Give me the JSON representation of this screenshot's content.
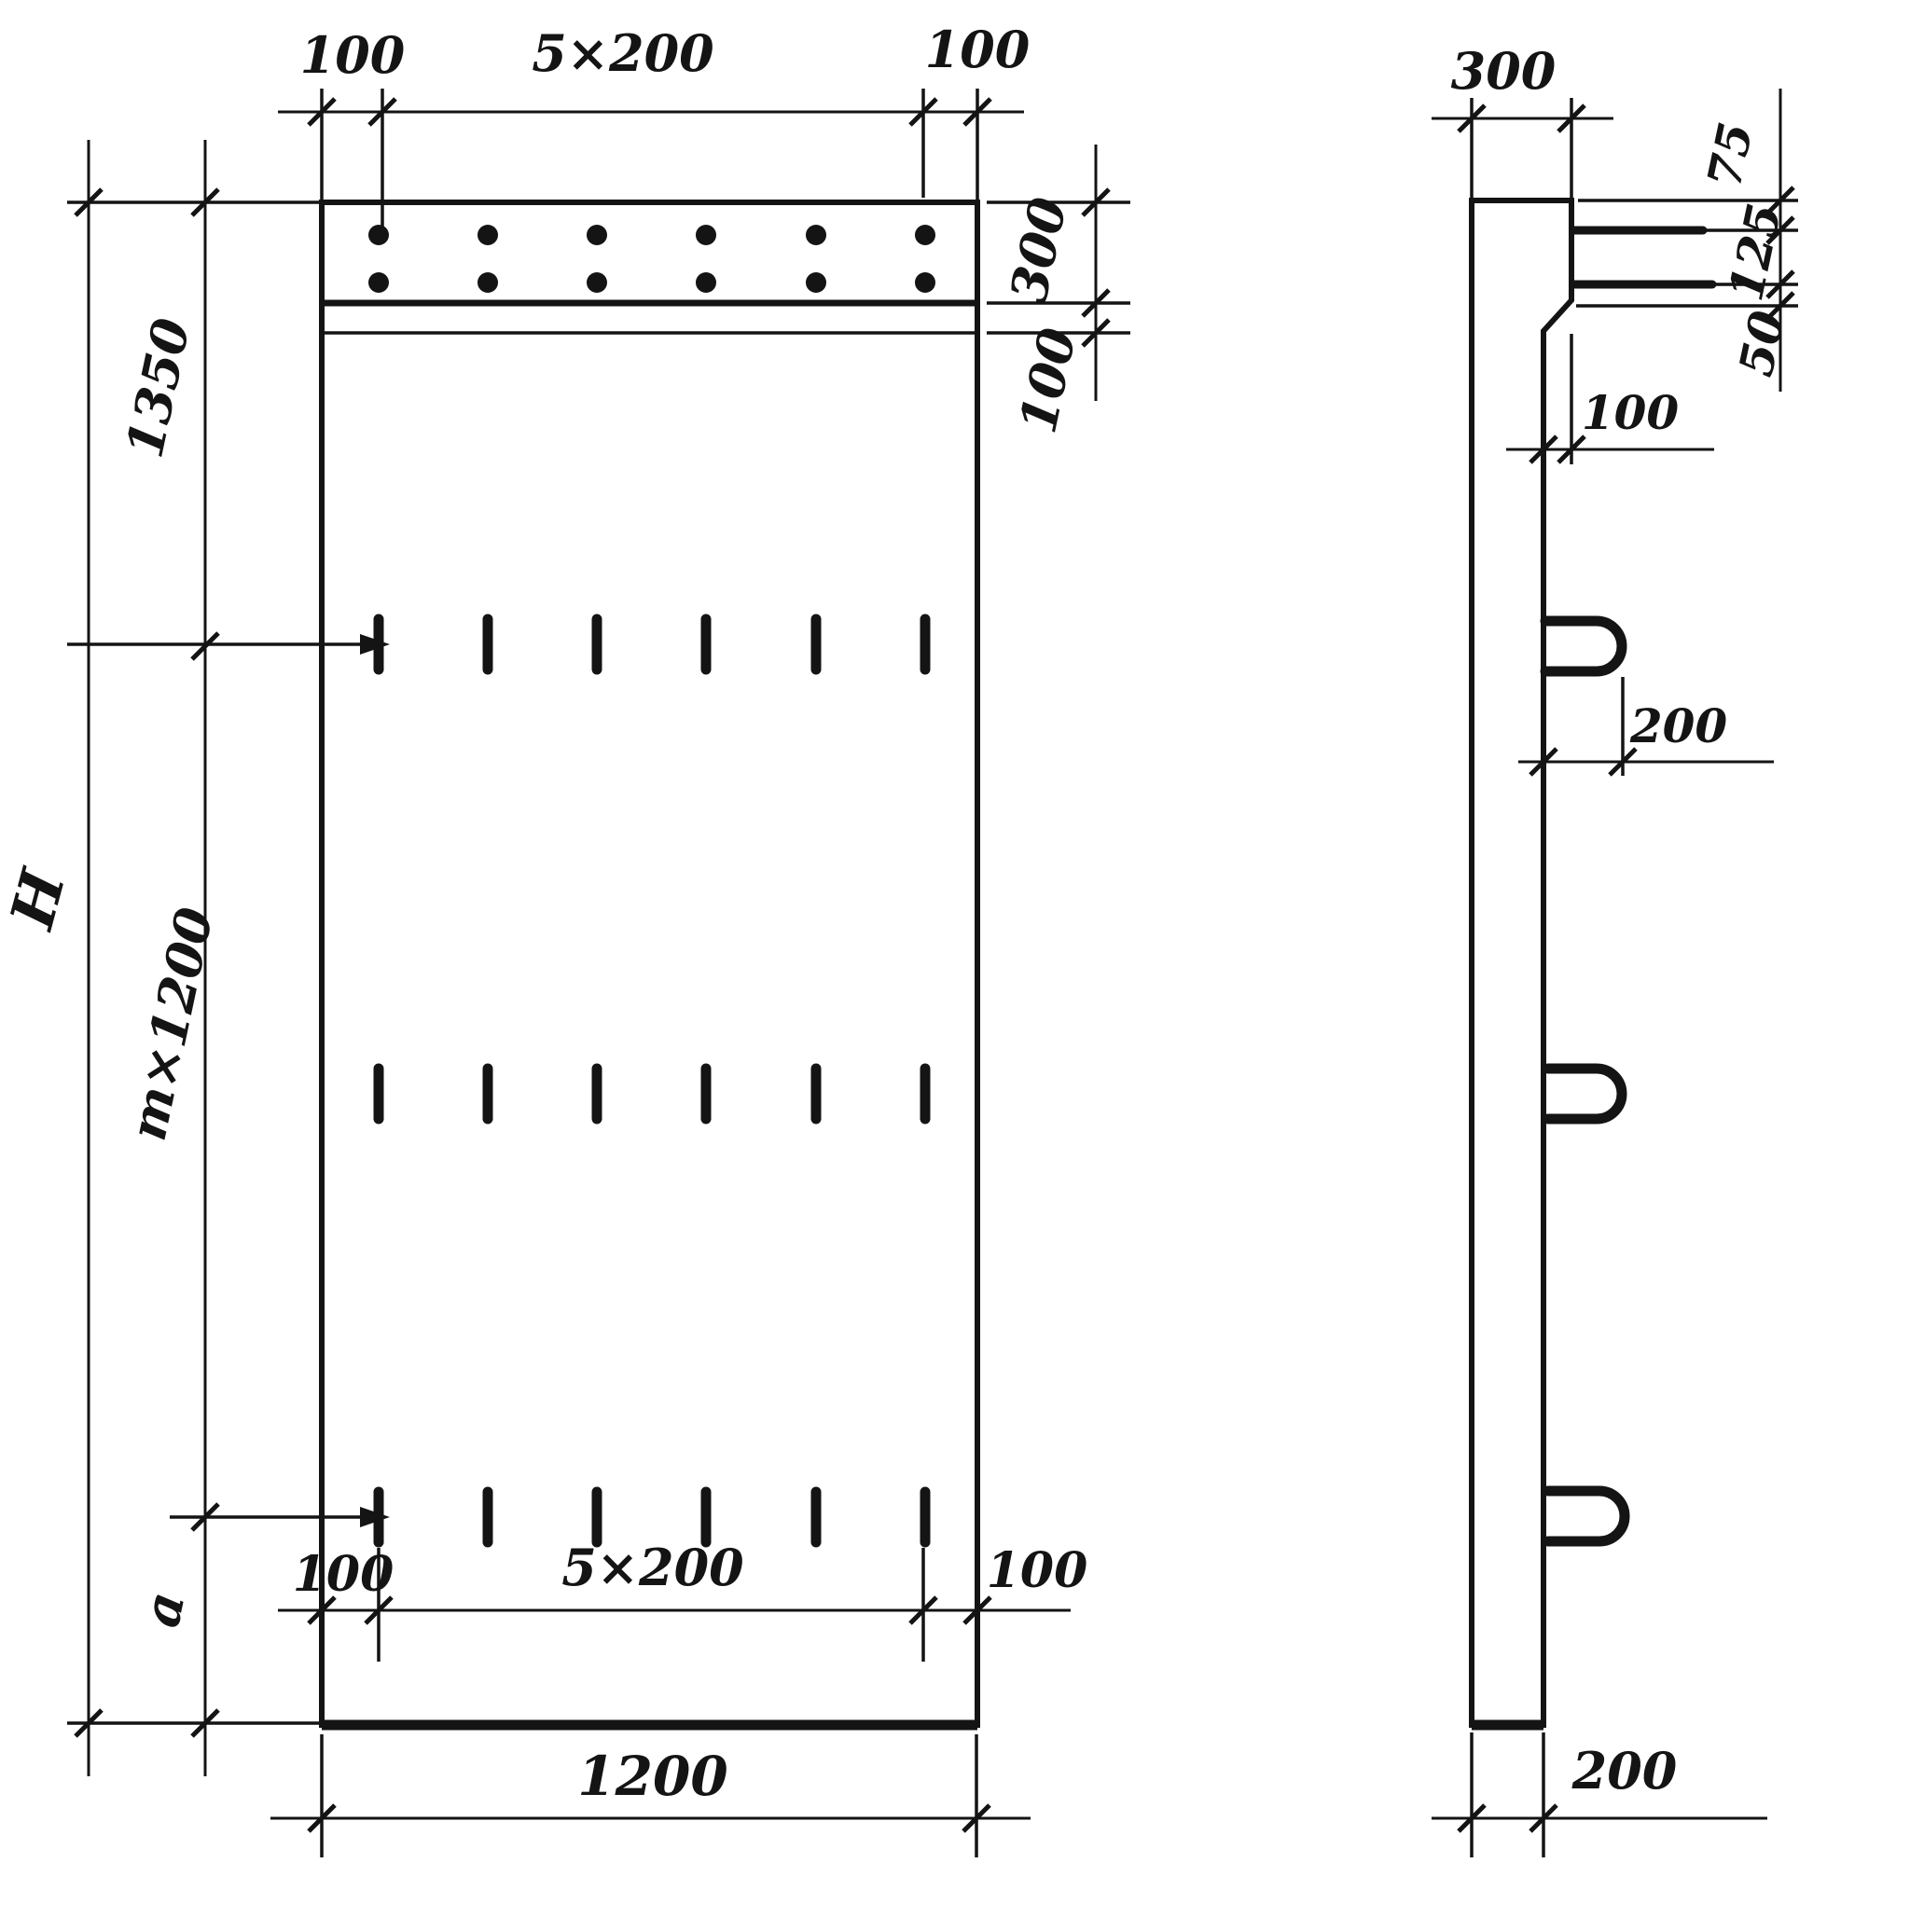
{
  "front_view": {
    "top": {
      "left_offset": "100",
      "spacing": "5×200",
      "right_offset": "100"
    },
    "right": {
      "band_height": "300",
      "band_gap": "100"
    },
    "left": {
      "top_segment": "1350",
      "overall_height": "H",
      "middle_segment": "m×1200",
      "bottom_segment": "a"
    },
    "bottom": {
      "left_offset": "100",
      "spacing": "5×200",
      "right_offset": "100",
      "overall_width": "1200"
    }
  },
  "side_view": {
    "top_thickness": "300",
    "right": {
      "top_to_first_bar": "75",
      "bar_to_bar": "125",
      "bar_to_edge": "50"
    },
    "step_offset": "100",
    "loop_protrusion": "200",
    "bottom_thickness": "200"
  }
}
